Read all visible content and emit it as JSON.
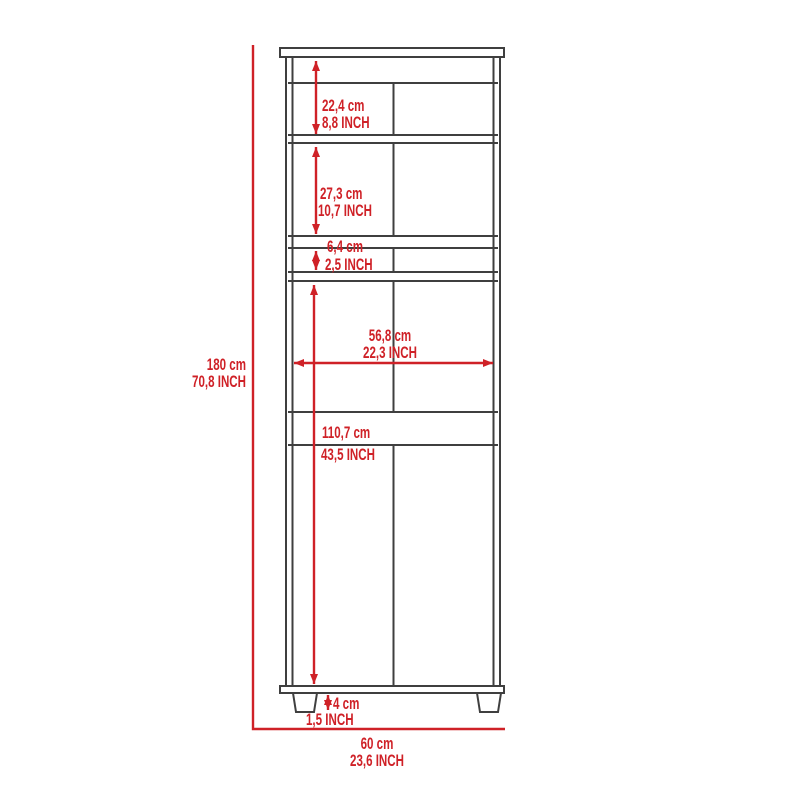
{
  "diagram": {
    "title": "cabinet-dimension-diagram",
    "type": "furniture elevation with dimension callouts",
    "accent_color": "#cf2127",
    "line_color": "#3f3f3f",
    "background_color": "#ffffff",
    "overall": {
      "height": {
        "cm": "180 cm",
        "inch": "70,8 INCH"
      },
      "width": {
        "cm": "60 cm",
        "inch": "23,6 INCH"
      }
    },
    "dimensions": [
      {
        "id": "top-compartment-height",
        "cm": "22,4 cm",
        "inch": "8,8 INCH"
      },
      {
        "id": "middle-compartment-height",
        "cm": "27,3 cm",
        "inch": "10,7 INCH"
      },
      {
        "id": "drawer-height",
        "cm": "6,4 cm",
        "inch": "2,5 INCH"
      },
      {
        "id": "interior-width",
        "cm": "56,8 cm",
        "inch": "22,3 INCH"
      },
      {
        "id": "lower-section-height",
        "cm": "110,7 cm",
        "inch": "43,5 INCH"
      },
      {
        "id": "leg-height",
        "cm": "4 cm",
        "inch": "1,5 INCH"
      }
    ]
  }
}
